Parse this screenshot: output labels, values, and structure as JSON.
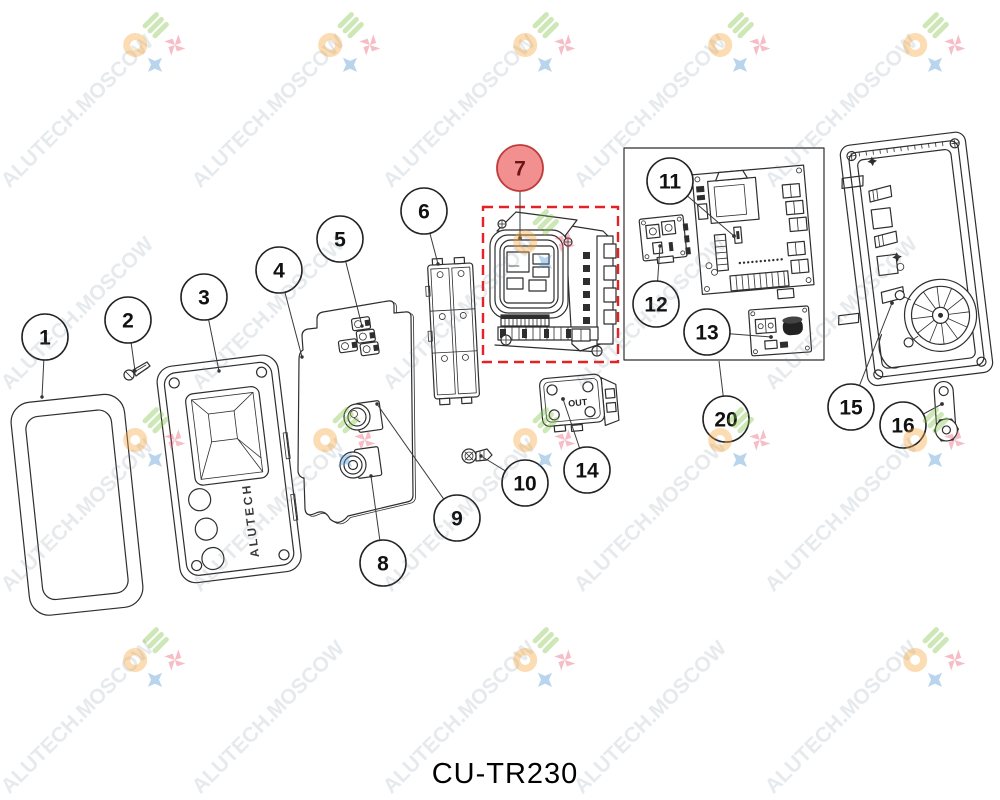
{
  "figure": {
    "caption": "CU-TR230"
  },
  "watermark": {
    "text": "ALUTECH.MOSCOW"
  },
  "panel": {
    "brand_vertical": "ALUTECH"
  },
  "part14": {
    "label": "OUT"
  },
  "callout_labels": [
    "1",
    "2",
    "3",
    "4",
    "5",
    "6",
    "7",
    "8",
    "9",
    "10",
    "11",
    "12",
    "13",
    "14",
    "15",
    "16",
    "20"
  ],
  "highlighted_callout": "7",
  "colors": {
    "highlight_fill": "#F2908F",
    "highlight_stroke": "#C13B3B",
    "highlight_text": "#6B1414",
    "dashed_box": "#E32126",
    "line_art": "#2e2e2e",
    "watermark_text": "#6c8496",
    "logo_orange": "#F5A43A",
    "logo_green": "#7DC242",
    "logo_blue": "#4A90D2",
    "logo_red": "#E8546B"
  }
}
